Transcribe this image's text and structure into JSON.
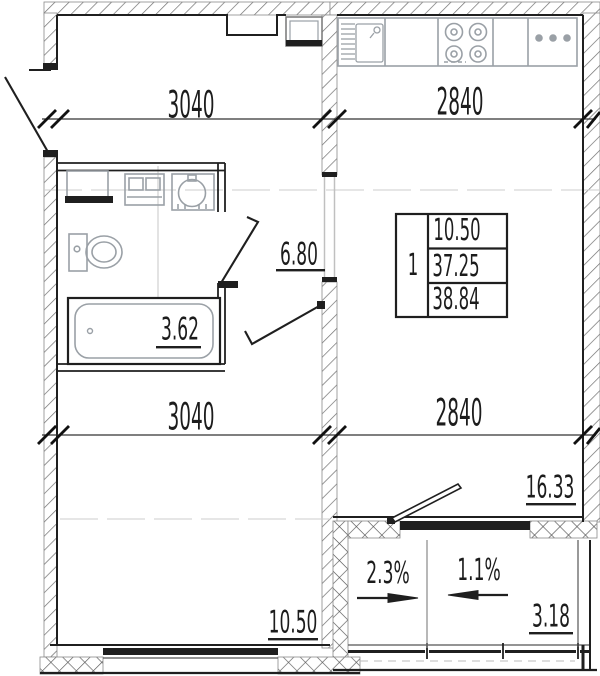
{
  "plan": {
    "dimensions": {
      "top_left": "3040",
      "top_right": "2840",
      "mid_left": "3040",
      "mid_right": "2840"
    },
    "areas": {
      "hallway": "6.80",
      "bathroom": "3.62",
      "room": "10.50",
      "kitchen_living": "16.33",
      "balcony": "3.18"
    },
    "slopes": {
      "balcony_left": "2.3%",
      "balcony_right": "1.1%"
    },
    "apartment_table": {
      "room_count": "1",
      "living_area": "10.50",
      "apartment_area": "37.25",
      "total_area": "38.84"
    },
    "colors": {
      "line": "#1f1f1f",
      "fixture": "#9aa0a6",
      "hatch": "#6f6f6f",
      "axis": "#cccccc",
      "background": "#ffffff"
    }
  }
}
